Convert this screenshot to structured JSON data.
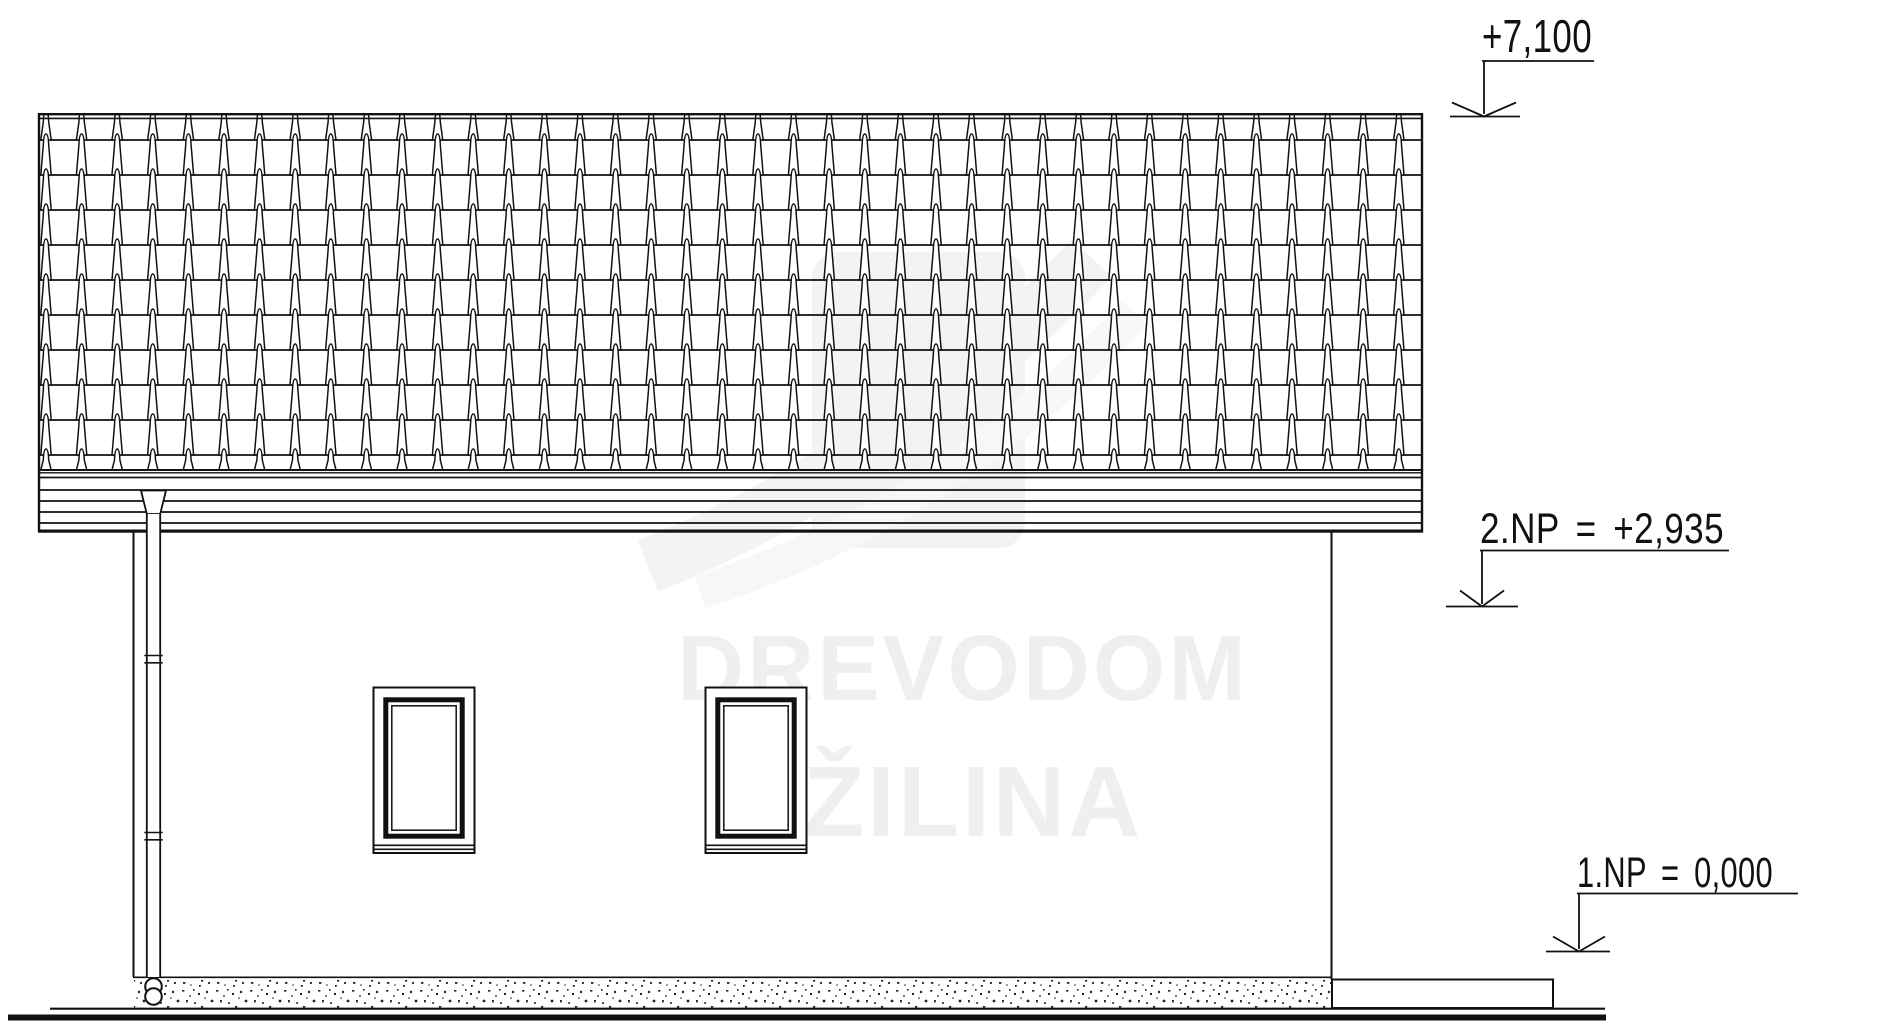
{
  "drawing": {
    "type": "house-side-elevation",
    "markers": {
      "ridge": {
        "label": "+7,100"
      },
      "floor2": {
        "label": "2.NP = +2,935"
      },
      "floor1": {
        "label": "1.NP = 0,000"
      }
    },
    "watermark": {
      "line1": "DREVODOM",
      "line2": "ŽILINA"
    }
  },
  "colors": {
    "background": "#ffffff",
    "line": "#111111",
    "watermark_text": "#efefef",
    "watermark_logo": "#f3f3f3"
  }
}
